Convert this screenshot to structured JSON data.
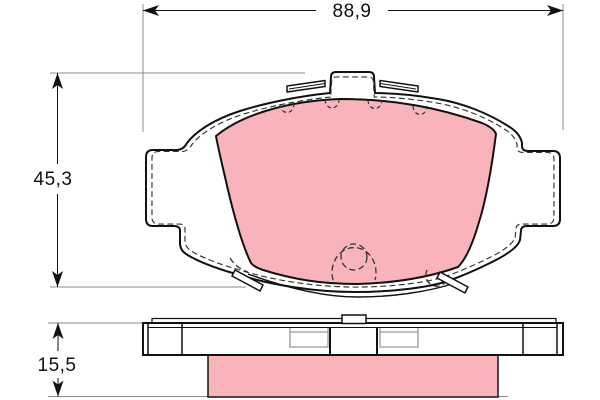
{
  "diagram": {
    "type": "technical-drawing",
    "subject": "disc-brake-pad-with-backing-plate",
    "views": {
      "front_view": "brake pad front (plan) view with friction material",
      "side_view": "brake pad edge (thickness) view with friction material"
    },
    "dimensions": {
      "width": {
        "value": "88,9"
      },
      "height": {
        "value": "45,3"
      },
      "thickness": {
        "value": "15,5"
      }
    },
    "colors": {
      "friction_material": "#F8B4BA",
      "outline": "#111111",
      "dimension_line": "#111111",
      "extension_line": "#8C8C8C",
      "hidden_line": "#333333",
      "background": "#FFFFFF"
    }
  }
}
